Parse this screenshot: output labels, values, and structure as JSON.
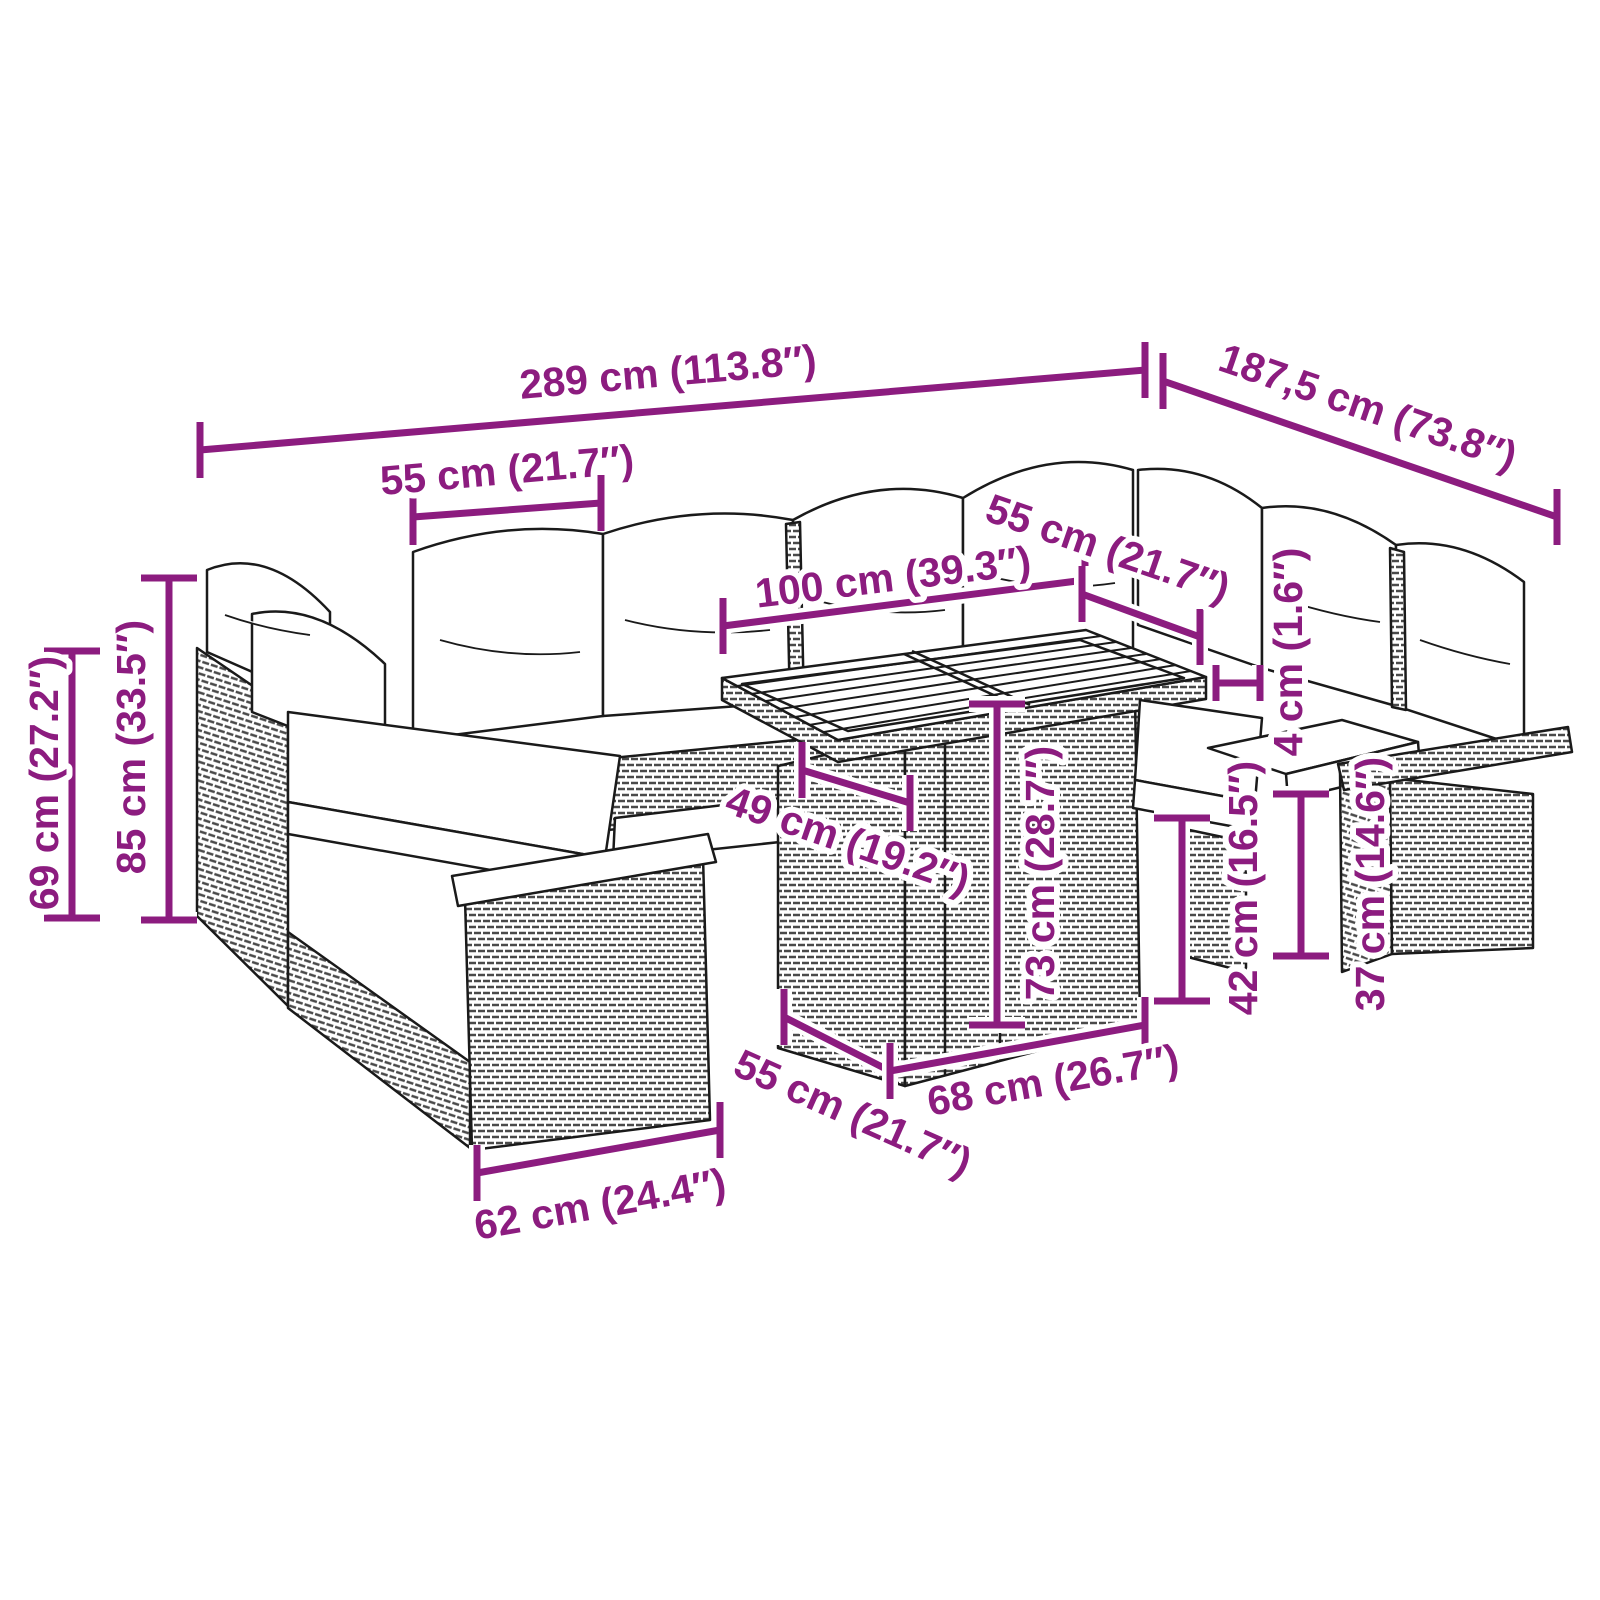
{
  "alt": "Dimension diagram of a rattan garden lounge set with corner sofa, armchair and slatted-top table",
  "colors": {
    "dimension": "#8C1C7F",
    "line_art": "#1a1a1a",
    "background": "#ffffff",
    "cushion": "#ffffff"
  },
  "diagram": {
    "dimensions": [
      {
        "id": "total-width",
        "label": "289 cm (113.8″)",
        "type": "linear",
        "line": {
          "x1": 200,
          "y1": 450,
          "x2": 1145,
          "y2": 370
        },
        "tick": "vertical",
        "label_x": 668,
        "label_y": 372,
        "label_rotation": -5
      },
      {
        "id": "total-depth",
        "label": "187,5 cm (73.8″)",
        "type": "linear",
        "line": {
          "x1": 1163,
          "y1": 381,
          "x2": 1557,
          "y2": 517
        },
        "tick": "vertical",
        "label_x": 1368,
        "label_y": 407,
        "label_rotation": 19
      },
      {
        "id": "seat-module-width",
        "label": "55 cm (21.7″)",
        "type": "linear",
        "line": {
          "x1": 413,
          "y1": 517,
          "x2": 601,
          "y2": 503
        },
        "tick": "vertical",
        "label_x": 507,
        "label_y": 470,
        "label_rotation": -5
      },
      {
        "id": "table-top-length",
        "label": "100 cm (39.3″)",
        "type": "linear",
        "line": {
          "x1": 723,
          "y1": 626,
          "x2": 1085,
          "y2": 580
        },
        "tick": "vertical",
        "label_x": 893,
        "label_y": 577,
        "label_rotation": -7
      },
      {
        "id": "right-module-width",
        "label": "55 cm (21.7″)",
        "type": "linear",
        "line": {
          "x1": 1082,
          "y1": 594,
          "x2": 1200,
          "y2": 637
        },
        "tick": "vertical",
        "label_x": 1108,
        "label_y": 548,
        "label_rotation": 19
      },
      {
        "id": "back-height",
        "label": "69 cm (27.2″)",
        "type": "linear",
        "line": {
          "x1": 72,
          "y1": 651,
          "x2": 72,
          "y2": 918
        },
        "tick": "horizontal",
        "label_x": 44,
        "label_y": 783,
        "label_rotation": -90
      },
      {
        "id": "total-height",
        "label": "85 cm (33.5″)",
        "type": "linear",
        "line": {
          "x1": 169,
          "y1": 578,
          "x2": 169,
          "y2": 920
        },
        "tick": "horizontal",
        "label_x": 131,
        "label_y": 747,
        "label_rotation": -90
      },
      {
        "id": "seat-depth",
        "label": "49 cm (19.2″)",
        "type": "linear",
        "line": {
          "x1": 802,
          "y1": 770,
          "x2": 910,
          "y2": 803
        },
        "tick": "vertical",
        "label_x": 848,
        "label_y": 840,
        "label_rotation": 19
      },
      {
        "id": "table-height",
        "label": "73 cm (28.7″)",
        "type": "linear",
        "line": {
          "x1": 997,
          "y1": 704,
          "x2": 997,
          "y2": 1025
        },
        "tick": "horizontal",
        "label_x": 1040,
        "label_y": 873,
        "label_rotation": -90
      },
      {
        "id": "cushion-thickness",
        "label": "4 cm (1.6″)",
        "type": "bracket",
        "bracket": {
          "x1": 1216,
          "x2": 1260,
          "y1": 665,
          "y2": 701
        },
        "label_x": 1288,
        "label_y": 652,
        "label_rotation": -90
      },
      {
        "id": "seat-height",
        "label": "42 cm (16.5″)",
        "type": "linear",
        "line": {
          "x1": 1182,
          "y1": 818,
          "x2": 1182,
          "y2": 1001
        },
        "tick": "horizontal",
        "label_x": 1243,
        "label_y": 888,
        "label_rotation": -90
      },
      {
        "id": "base-height",
        "label": "37 cm (14.6″)",
        "type": "linear",
        "line": {
          "x1": 1301,
          "y1": 794,
          "x2": 1301,
          "y2": 956
        },
        "tick": "horizontal",
        "label_x": 1370,
        "label_y": 884,
        "label_rotation": -90
      },
      {
        "id": "table-base-depth",
        "label": "55 cm (21.7″)",
        "type": "linear",
        "line": {
          "x1": 784,
          "y1": 1017,
          "x2": 890,
          "y2": 1071
        },
        "tick": "vertical",
        "label_x": 853,
        "label_y": 1113,
        "label_rotation": 24
      },
      {
        "id": "table-base-width",
        "label": "68 cm (26.7″)",
        "type": "linear",
        "line": {
          "x1": 890,
          "y1": 1071,
          "x2": 1145,
          "y2": 1025
        },
        "tick": "vertical",
        "label_x": 1053,
        "label_y": 1080,
        "label_rotation": -10
      },
      {
        "id": "front-module-width",
        "label": "62 cm (24.4″)",
        "type": "linear",
        "line": {
          "x1": 477,
          "y1": 1173,
          "x2": 720,
          "y2": 1130
        },
        "tick": "vertical",
        "label_x": 600,
        "label_y": 1204,
        "label_rotation": -10
      }
    ]
  }
}
